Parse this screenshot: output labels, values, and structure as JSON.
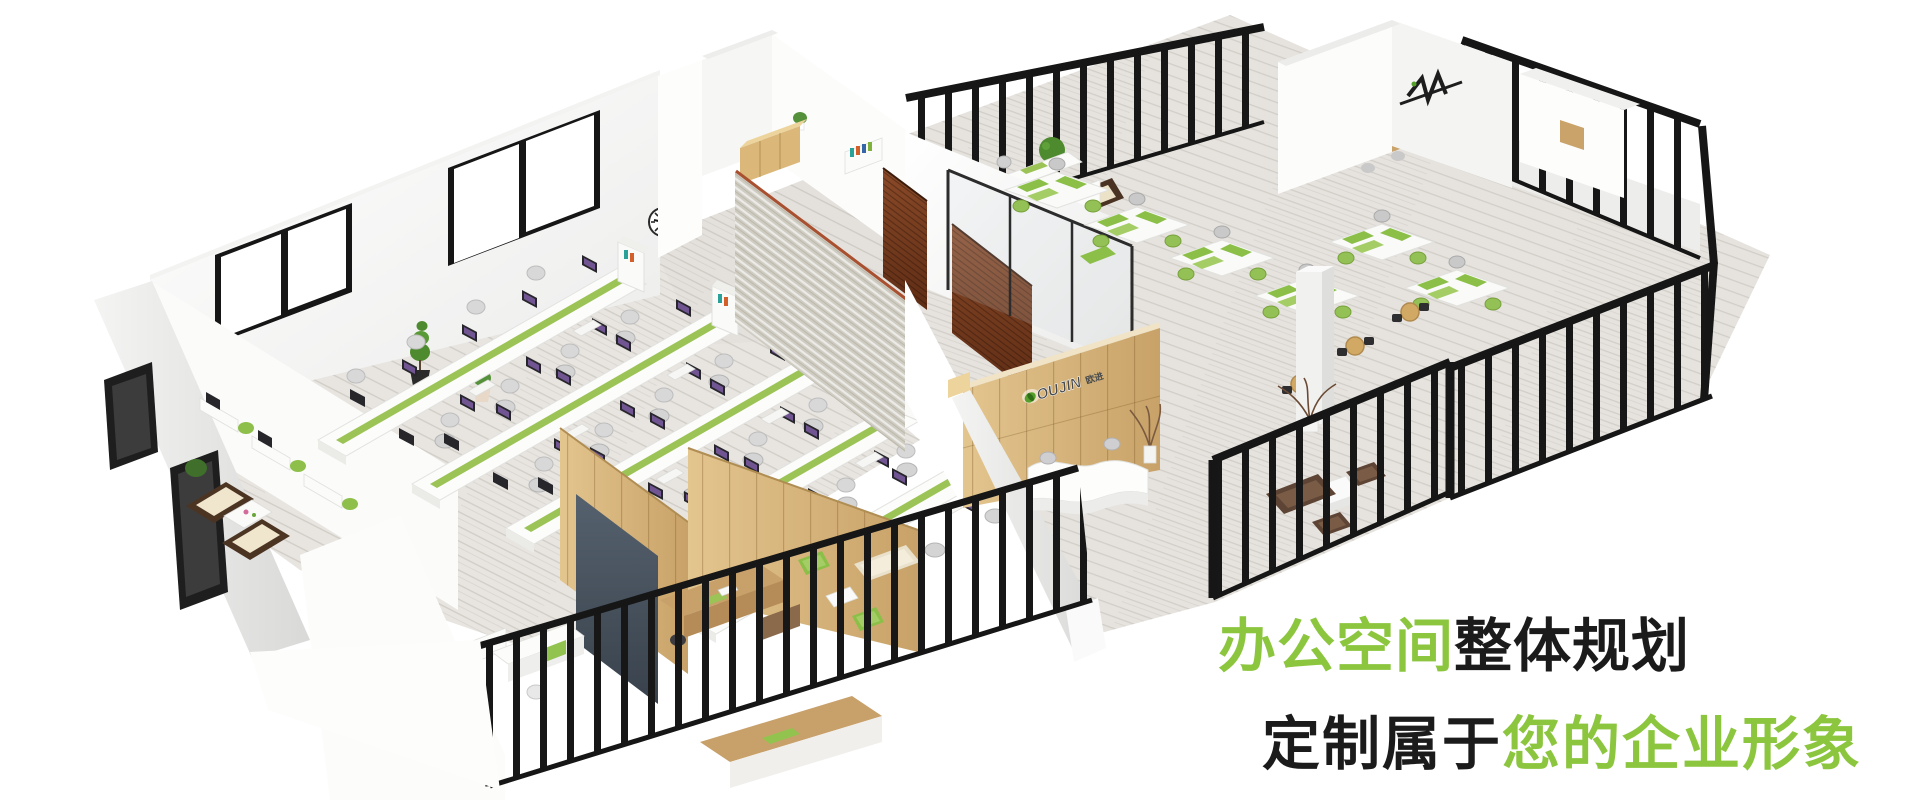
{
  "headline": {
    "line1_green": "办公空间",
    "line1_black": "整体规划",
    "line2_black": "定制属于",
    "line2_green": "您的企业形象",
    "green_color": "#8cc63f",
    "text_color": "#1b1b1b"
  },
  "logo": {
    "name": "OUJIN",
    "suffix": "欧进",
    "leaf_color": "#55a02c",
    "text_color": "#474a4d"
  },
  "scene": {
    "type": "isometric-office-floorplan-render",
    "clock_time": "9:10",
    "palette": {
      "background": "#ffffff",
      "wall": "#ffffff",
      "wall_shadow": "#e6e6e6",
      "floor": "#e7e4e0",
      "accent_green": "#8cc63f",
      "fence_black": "#171717",
      "oak_wood": "#d8b57a",
      "walnut_wood": "#7c3f22",
      "brick": "#cfccc2",
      "slate": "#4c5763",
      "sofa_brown": "#5d4434",
      "cream": "#eae2cc"
    }
  }
}
